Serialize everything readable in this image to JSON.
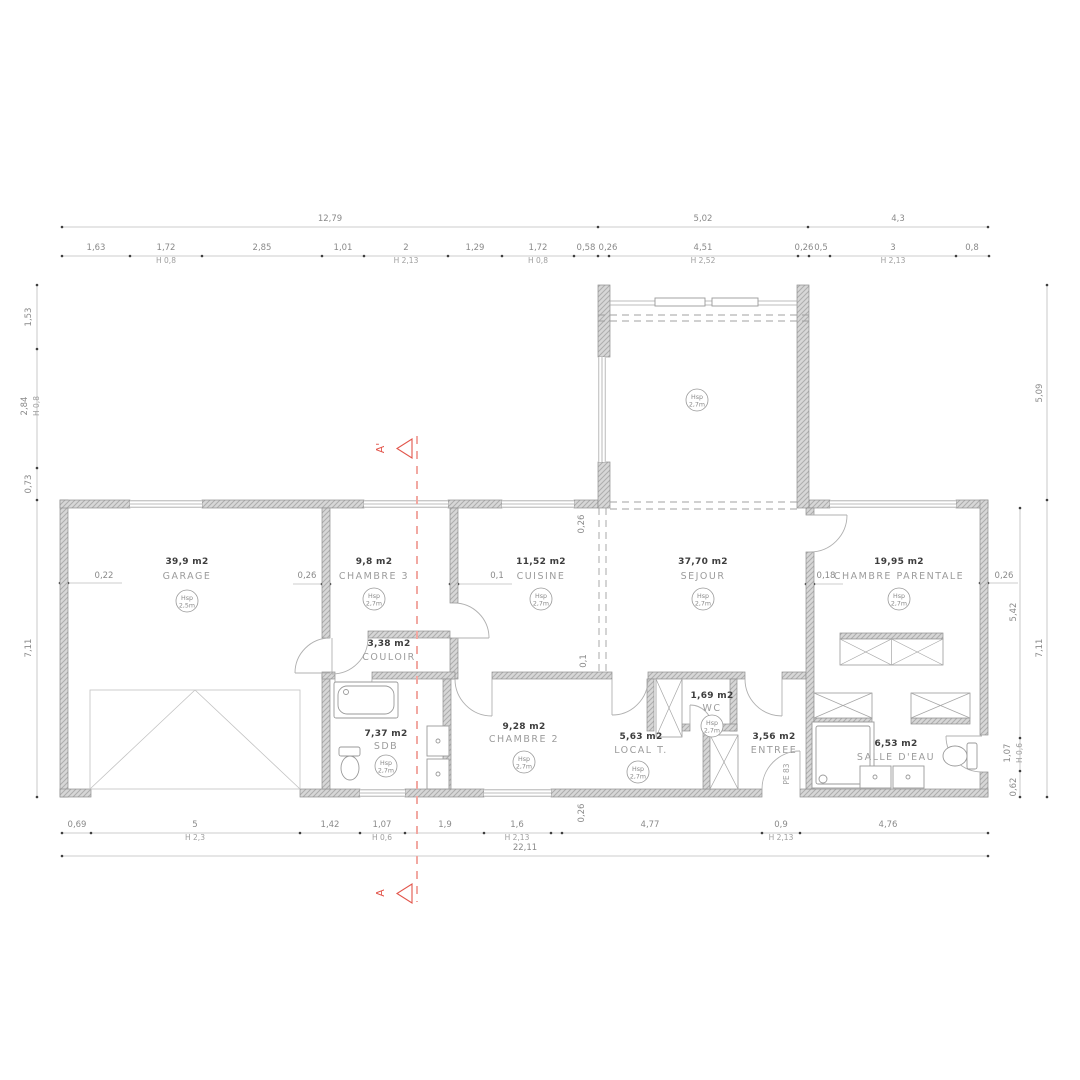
{
  "drawing": {
    "kind": "house-floor-plan",
    "overall_width_label": "22,11"
  },
  "colors": {
    "wall_fill": "#d7d7d7",
    "wall_hatch": "#adadad",
    "thin_line": "#a8a8a8",
    "dim_text": "#8a8a8a",
    "area_text": "#3d3d3d",
    "room_text": "#9c9c9c",
    "section_red": "#e2554b",
    "section_line_red": "#f2a8a2"
  },
  "section_markers": {
    "top": "A'",
    "bottom": "A"
  },
  "rooms": [
    {
      "id": "garage",
      "name": "GARAGE",
      "area": "39,9 m2",
      "x": 187,
      "area_y": 564,
      "name_y": 579,
      "badge": {
        "l1": "Hsp",
        "l2": "2,5m",
        "x": 187,
        "y": 601
      }
    },
    {
      "id": "chambre-3",
      "name": "CHAMBRE 3",
      "area": "9,8 m2",
      "x": 374,
      "area_y": 564,
      "name_y": 579,
      "badge": {
        "l1": "Hsp",
        "l2": "2,7m",
        "x": 374,
        "y": 599
      }
    },
    {
      "id": "cuisine",
      "name": "CUISINE",
      "area": "11,52 m2",
      "x": 541,
      "area_y": 564,
      "name_y": 579,
      "badge": {
        "l1": "Hsp",
        "l2": "2,7m",
        "x": 541,
        "y": 599
      }
    },
    {
      "id": "sejour",
      "name": "SEJOUR",
      "area": "37,70 m2",
      "x": 703,
      "area_y": 564,
      "name_y": 579,
      "badge": {
        "l1": "Hsp",
        "l2": "2,7m",
        "x": 703,
        "y": 599
      }
    },
    {
      "id": "chambre-parentale",
      "name": "CHAMBRE PARENTALE",
      "area": "19,95 m2",
      "x": 899,
      "area_y": 564,
      "name_y": 579,
      "badge": {
        "l1": "Hsp",
        "l2": "2,7m",
        "x": 899,
        "y": 599
      }
    },
    {
      "id": "couloir",
      "name": "COULOIR",
      "area": "3,38 m2",
      "x": 389,
      "area_y": 646,
      "name_y": 660
    },
    {
      "id": "sdb",
      "name": "SDB",
      "area": "7,37 m2",
      "x": 386,
      "area_y": 736,
      "name_y": 749,
      "badge": {
        "l1": "Hsp",
        "l2": "2,7m",
        "x": 386,
        "y": 766
      }
    },
    {
      "id": "chambre-2",
      "name": "CHAMBRE 2",
      "area": "9,28 m2",
      "x": 524,
      "area_y": 729,
      "name_y": 742,
      "badge": {
        "l1": "Hsp",
        "l2": "2,7m",
        "x": 524,
        "y": 762
      }
    },
    {
      "id": "local-t",
      "name": "LOCAL T.",
      "area": "5,63 m2",
      "x": 641,
      "area_y": 739,
      "name_y": 753,
      "badge": {
        "l1": "Hsp",
        "l2": "2,7m",
        "x": 638,
        "y": 772
      }
    },
    {
      "id": "wc",
      "name": "WC",
      "area": "1,69 m2",
      "x": 712,
      "area_y": 698,
      "name_y": 711,
      "badge": {
        "l1": "Hsp",
        "l2": "2,7m",
        "x": 712,
        "y": 726
      }
    },
    {
      "id": "entree",
      "name": "ENTREE",
      "area": "3,56 m2",
      "x": 774,
      "area_y": 739,
      "name_y": 753
    },
    {
      "id": "salle-d-eau",
      "name": "SALLE D'EAU",
      "area": "6,53 m2",
      "x": 896,
      "area_y": 746,
      "name_y": 760
    }
  ],
  "extra_badges": [
    {
      "l1": "Hsp",
      "l2": "2,7m",
      "x": 697,
      "y": 400
    }
  ],
  "dim_labels": [
    {
      "t": "12,79",
      "x": 330,
      "y": 221
    },
    {
      "t": "5,02",
      "x": 703,
      "y": 221
    },
    {
      "t": "4,3",
      "x": 898,
      "y": 221
    },
    {
      "t": "1,63",
      "x": 96,
      "y": 250
    },
    {
      "t": "1,72",
      "x": 166,
      "y": 250
    },
    {
      "t": "2,85",
      "x": 262,
      "y": 250
    },
    {
      "t": "1,01",
      "x": 343,
      "y": 250
    },
    {
      "t": "2",
      "x": 406,
      "y": 250
    },
    {
      "t": "1,29",
      "x": 475,
      "y": 250
    },
    {
      "t": "1,72",
      "x": 538,
      "y": 250
    },
    {
      "t": "0,58",
      "x": 586,
      "y": 250
    },
    {
      "t": "0,26",
      "x": 608,
      "y": 250
    },
    {
      "t": "4,51",
      "x": 703,
      "y": 250
    },
    {
      "t": "0,26",
      "x": 804,
      "y": 250
    },
    {
      "t": "0,5",
      "x": 821,
      "y": 250
    },
    {
      "t": "3",
      "x": 893,
      "y": 250
    },
    {
      "t": "0,8",
      "x": 972,
      "y": 250
    },
    {
      "t": "H 0,8",
      "x": 166,
      "y": 263,
      "cls": "dimh"
    },
    {
      "t": "H 2,13",
      "x": 406,
      "y": 263,
      "cls": "dimh"
    },
    {
      "t": "H 0,8",
      "x": 538,
      "y": 263,
      "cls": "dimh"
    },
    {
      "t": "H 2,52",
      "x": 703,
      "y": 263,
      "cls": "dimh"
    },
    {
      "t": "H 2,13",
      "x": 893,
      "y": 263,
      "cls": "dimh"
    },
    {
      "t": "0,69",
      "x": 77,
      "y": 827
    },
    {
      "t": "5",
      "x": 195,
      "y": 827
    },
    {
      "t": "1,42",
      "x": 330,
      "y": 827
    },
    {
      "t": "1,07",
      "x": 382,
      "y": 827
    },
    {
      "t": "1,9",
      "x": 445,
      "y": 827
    },
    {
      "t": "1,6",
      "x": 517,
      "y": 827
    },
    {
      "t": "4,77",
      "x": 650,
      "y": 827
    },
    {
      "t": "0,9",
      "x": 781,
      "y": 827
    },
    {
      "t": "4,76",
      "x": 888,
      "y": 827
    },
    {
      "t": "H 2,3",
      "x": 195,
      "y": 840,
      "cls": "dimh"
    },
    {
      "t": "H 0,6",
      "x": 382,
      "y": 840,
      "cls": "dimh"
    },
    {
      "t": "H 2,13",
      "x": 517,
      "y": 840,
      "cls": "dimh"
    },
    {
      "t": "H 2,13",
      "x": 781,
      "y": 840,
      "cls": "dimh"
    },
    {
      "t": "22,11",
      "x": 525,
      "y": 850
    },
    {
      "t": "1,53",
      "x": 31,
      "y": 317,
      "rot": 1
    },
    {
      "t": "2,84",
      "x": 27,
      "y": 406,
      "rot": 1
    },
    {
      "t": "H 0,8",
      "x": 39,
      "y": 406,
      "rot": 1,
      "cls": "dimh"
    },
    {
      "t": "0,73",
      "x": 31,
      "y": 484,
      "rot": 1
    },
    {
      "t": "7,11",
      "x": 31,
      "y": 648,
      "rot": 1
    },
    {
      "t": "0,22",
      "x": 104,
      "y": 578
    },
    {
      "t": "5,09",
      "x": 1042,
      "y": 393,
      "rot": 1
    },
    {
      "t": "7,11",
      "x": 1042,
      "y": 648,
      "rot": 1
    },
    {
      "t": "0,26",
      "x": 1004,
      "y": 578
    },
    {
      "t": "5,42",
      "x": 1016,
      "y": 612,
      "rot": 1
    },
    {
      "t": "1,07",
      "x": 1010,
      "y": 753,
      "rot": 1
    },
    {
      "t": "H 0,6",
      "x": 1022,
      "y": 753,
      "rot": 1,
      "cls": "dimh"
    },
    {
      "t": "0,62",
      "x": 1016,
      "y": 787,
      "rot": 1
    },
    {
      "t": "0,26",
      "x": 307,
      "y": 578
    },
    {
      "t": "0,1",
      "x": 497,
      "y": 578
    },
    {
      "t": "0,18",
      "x": 826,
      "y": 578
    },
    {
      "t": "0,26",
      "x": 584,
      "y": 524,
      "rot": 1
    },
    {
      "t": "0,1",
      "x": 586,
      "y": 661,
      "rot": 1
    },
    {
      "t": "0,26",
      "x": 584,
      "y": 813,
      "rot": 1
    },
    {
      "t": "PE 83",
      "x": 789,
      "y": 774,
      "rot": 1,
      "cls": "dimh"
    },
    {
      "t": "A'",
      "x": 384,
      "y": 448,
      "rot": 1,
      "cls": "sec",
      "name": "section-label-a-prime"
    },
    {
      "t": "A",
      "x": 384,
      "y": 893,
      "rot": 1,
      "cls": "sec",
      "name": "section-label-a"
    }
  ]
}
